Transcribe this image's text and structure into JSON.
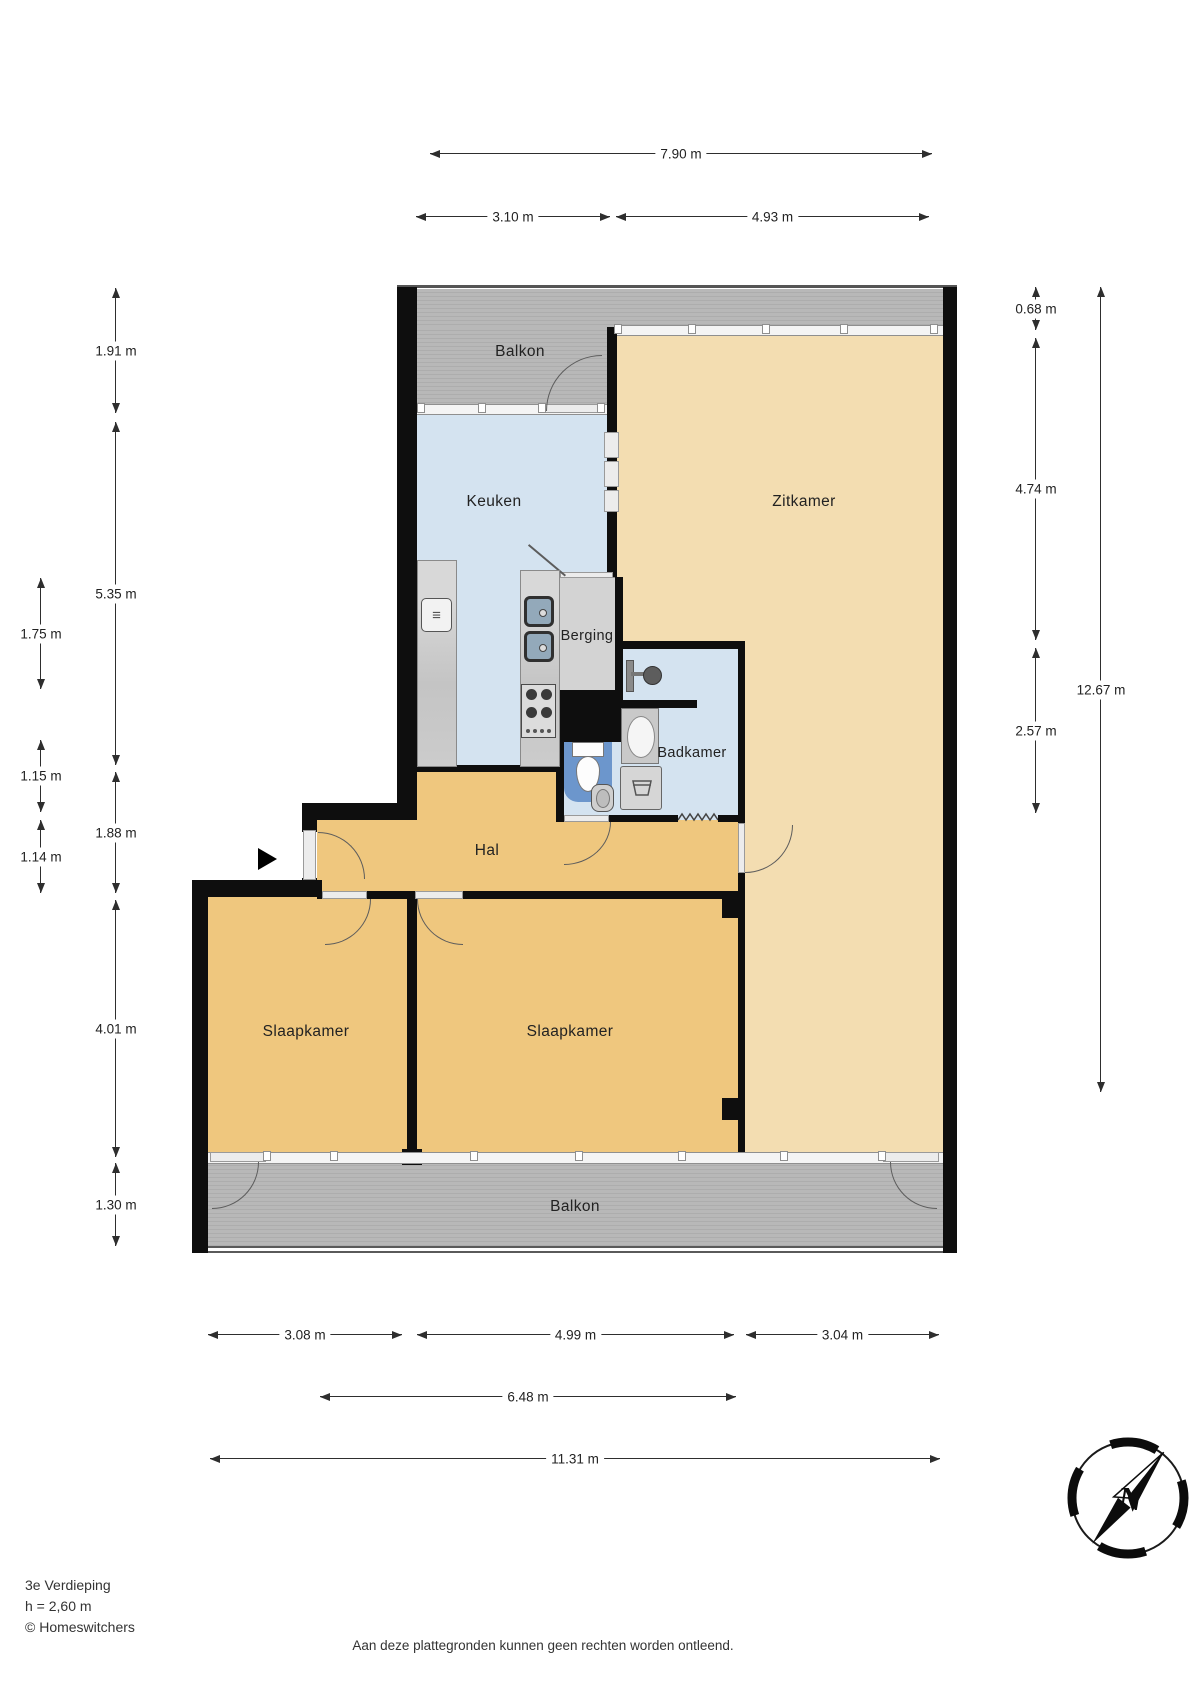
{
  "rooms": [
    {
      "id": "balkon-top",
      "label": "Balkon"
    },
    {
      "id": "keuken",
      "label": "Keuken"
    },
    {
      "id": "zitkamer",
      "label": "Zitkamer"
    },
    {
      "id": "berging",
      "label": "Berging"
    },
    {
      "id": "badkamer",
      "label": "Badkamer"
    },
    {
      "id": "hal",
      "label": "Hal"
    },
    {
      "id": "slaapkamer-left",
      "label": "Slaapkamer"
    },
    {
      "id": "slaapkamer-right",
      "label": "Slaapkamer"
    },
    {
      "id": "balkon-bottom",
      "label": "Balkon"
    }
  ],
  "dimensions": {
    "top": [
      {
        "label": "7.90 m"
      },
      {
        "label": "3.10 m"
      },
      {
        "label": "4.93 m"
      }
    ],
    "left_inner": [
      {
        "label": "1.91 m"
      },
      {
        "label": "5.35 m"
      },
      {
        "label": "1.88 m"
      },
      {
        "label": "4.01 m"
      },
      {
        "label": "1.30 m"
      }
    ],
    "left_outer": [
      {
        "label": "1.75 m"
      },
      {
        "label": "1.15 m"
      },
      {
        "label": "1.14 m"
      }
    ],
    "right": [
      {
        "label": "0.68 m"
      },
      {
        "label": "4.74 m"
      },
      {
        "label": "2.57 m"
      },
      {
        "label": "12.67 m"
      }
    ],
    "bottom": [
      {
        "label": "3.08 m"
      },
      {
        "label": "4.99 m"
      },
      {
        "label": "3.04 m"
      },
      {
        "label": "6.48 m"
      },
      {
        "label": "11.31 m"
      }
    ]
  },
  "footer": {
    "floor": "3e Verdieping",
    "ceiling_height": "h = 2,60 m",
    "copyright": "© Homeswitchers",
    "disclaimer": "Aan deze plattegronden kunnen geen rechten worden ontleend."
  },
  "compass": {
    "north_label": "N"
  },
  "icons": {
    "entrance-arrow": "black right-pointing triangle",
    "oven_glyph": "≡",
    "compass-rose": "circle ring with needle and N",
    "laundry-tub": "trapezoid basin glyph",
    "zigzag-threshold": "wavy line at bathroom entry"
  },
  "colors": {
    "wall": "#0e0e0e",
    "balcony": "#b5b5b5",
    "kitchen_bath": "#d4e3f0",
    "living": "#f3ddb1",
    "hall_bedrooms": "#efc77e",
    "toilet_accent": "#6c96cc",
    "counter": "#c9c9c9"
  }
}
